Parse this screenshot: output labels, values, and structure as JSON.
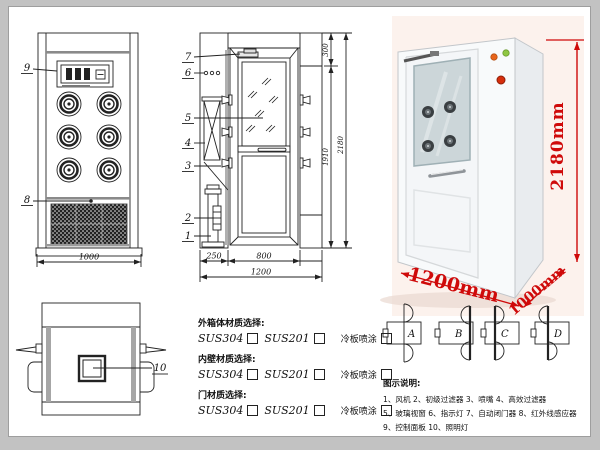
{
  "front_view": {
    "callout_control_panel": "9",
    "callout_grille": "8",
    "dim_width": "1000"
  },
  "side_view": {
    "callout_door_closer": "7",
    "callout_indicator_light": "6",
    "callout_glass_window": "5",
    "callout_hepa_filter": "4",
    "callout_nozzle": "3",
    "callout_primary_filter": "2",
    "callout_fan": "1",
    "dim_top": "300",
    "dim_inner_height": "1910",
    "dim_total_height": "2180",
    "dim_left": "250",
    "dim_door_width": "800",
    "dim_total_width": "1200"
  },
  "top_view": {
    "callout_lamp": "10"
  },
  "photo": {
    "dim_height": "2180mm",
    "dim_width": "1200mm",
    "dim_depth": "1000mm",
    "accent_red": "#cf0a0a",
    "light_green": "#8fc742",
    "light_orange": "#e8641b",
    "button_red": "#d62e0c"
  },
  "materials": {
    "sections": [
      {
        "title": "外箱体材质选择:",
        "options": [
          "SUS304",
          "SUS201",
          "冷板喷涂"
        ]
      },
      {
        "title": "内壁材质选择:",
        "options": [
          "SUS304",
          "SUS201",
          "冷板喷涂"
        ]
      },
      {
        "title": "门材质选择:",
        "options": [
          "SUS304",
          "SUS201",
          "冷板喷涂"
        ]
      }
    ]
  },
  "door_diagrams": {
    "labels": [
      "A",
      "B",
      "C",
      "D"
    ]
  },
  "legend": {
    "title": "图示说明:",
    "lines": [
      "1、风机    2、初级过滤器    3、喷嘴    4、高效过滤器",
      "5、玻璃视窗    6、指示灯   7、自动闭门器    8、红外线感应器",
      "9、控制面板    10、照明灯"
    ]
  }
}
